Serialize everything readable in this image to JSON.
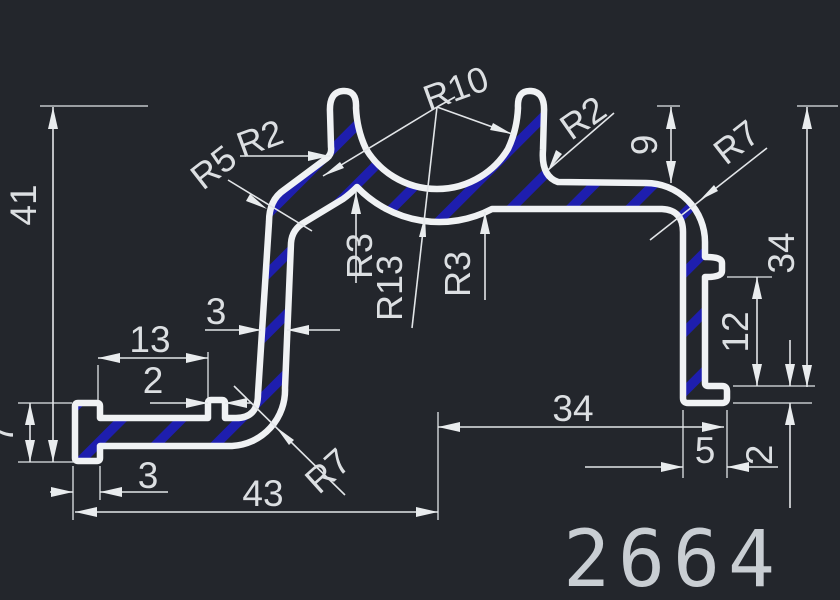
{
  "title": {
    "part_number": "2664"
  },
  "colors": {
    "background": "#23262c",
    "profile_line": "#f0f2f4",
    "dimension_line": "#e2e5e8",
    "hatch_blue": "#1e1eae",
    "text": "#dcdfe2",
    "part_number_text": "#c9ced3"
  },
  "dims": {
    "overall_height": "41",
    "left_foot_height": "7",
    "left_foot_width": "3",
    "overall_width": "43",
    "arm_to_notch": "13",
    "notch_width": "2",
    "wall_thickness": "3",
    "right_span": "34",
    "right_foot_width": "5",
    "right_foot_thickness": "2",
    "notch_to_foot": "12",
    "right_height": "34",
    "channel_top_depth": "9"
  },
  "radii": {
    "left_prong_fillet": "R2",
    "top_left_corner": "R5",
    "channel_inner": "R10",
    "right_prong_fillet": "R2",
    "channel_outer": "R13",
    "channel_left_fillet": "R3",
    "channel_right_fillet": "R3",
    "top_right_corner": "R7",
    "bottom_left_corner": "R7"
  }
}
